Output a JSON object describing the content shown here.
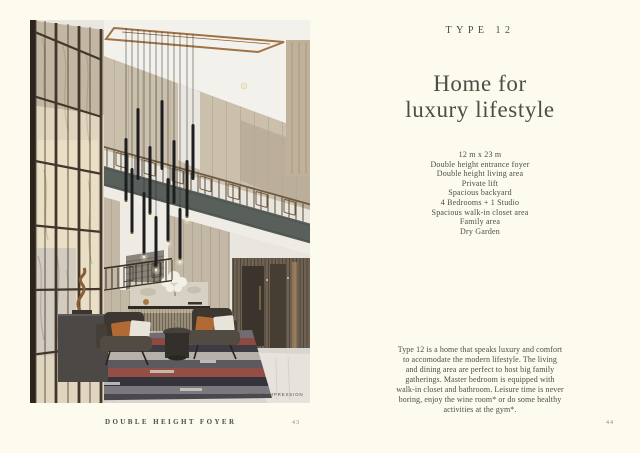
{
  "theme": {
    "background": "#fcfbee",
    "ink": "#4b4f46",
    "muted_page_number": "#8b8b80",
    "photo_accents": {
      "copper_trim": "#a07244",
      "bronze_frame": "#43362a",
      "marble_panel": "#e3dac4",
      "balcony_fascia": "#59605b",
      "pendant_black": "#1e1e20",
      "cushion_orange": "#b26a35",
      "rug_red": "#8c4a41",
      "floor_light": "#d9d6d0"
    }
  },
  "left_page": {
    "caption": "DOUBLE HEIGHT FOYER",
    "page_number": "43",
    "photo": {
      "alt": "Double height foyer interior rendering",
      "watermark": "ARTIST IMPRESSION"
    }
  },
  "right_page": {
    "type_label": "TYPE 12",
    "title_lines": [
      "Home for",
      "luxury lifestyle"
    ],
    "features": [
      "12 m x 23 m",
      "Double height entrance foyer",
      "Double height living area",
      "Private lift",
      "Spacious backyard",
      "4 Bedrooms + 1 Studio",
      "Spacious walk-in closet area",
      "Family area",
      "Dry Garden"
    ],
    "description_lines": [
      "Type 12 is a home that speaks luxury and comfort",
      "to accomodate the modern lifestyle. The living",
      "and dining area are perfect to host big family",
      "gatherings. Master bedroom is equipped with",
      "walk-in closet and bathroom. Leisure time is never",
      "boring, enjoy the wine room* or do some healthy",
      "activities at the gym*."
    ],
    "page_number": "44"
  }
}
